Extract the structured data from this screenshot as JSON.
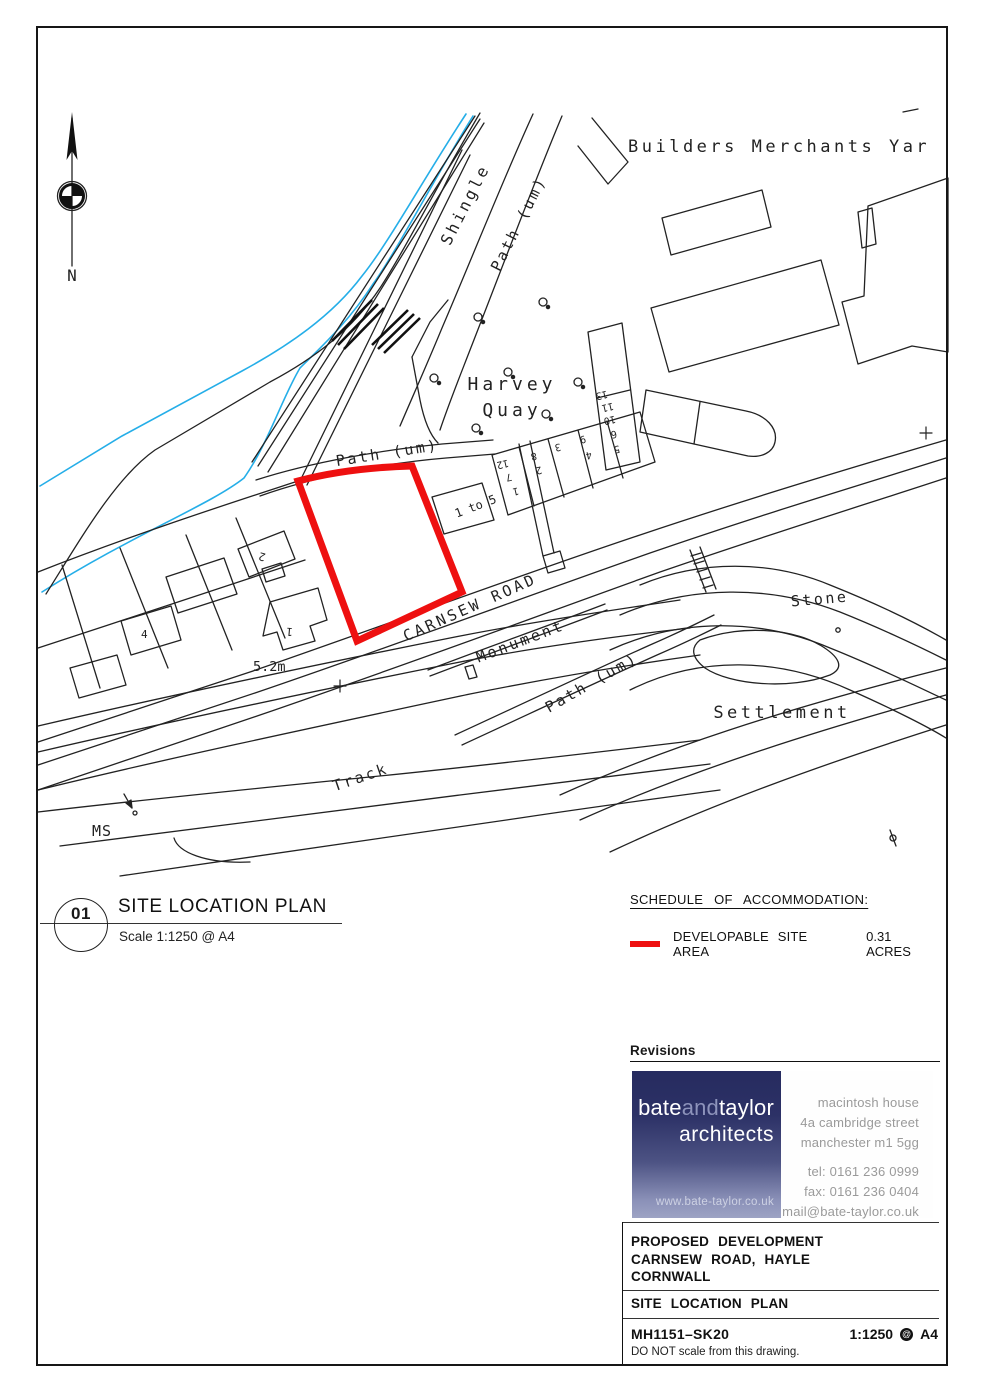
{
  "page": {
    "title_circle": "01",
    "drawing_title": "SITE LOCATION PLAN",
    "scale_note": "Scale 1:1250 @ A4"
  },
  "legend": {
    "heading": "SCHEDULE OF ACCOMMODATION:",
    "item_label": "DEVELOPABLE SITE AREA",
    "item_value": "0.31 ACRES",
    "swatch_color": "#ee1010"
  },
  "revisions": {
    "heading": "Revisions"
  },
  "logo": {
    "name_part1": "bate",
    "name_part2": "and",
    "name_part3": "taylor",
    "subtitle": "architects",
    "website": "www.bate-taylor.co.uk",
    "address_lines": [
      "macintosh house",
      "4a cambridge street",
      "manchester m1 5gg"
    ],
    "contact_lines": [
      "tel: 0161 236 0999",
      "fax: 0161 236 0404",
      "mail@bate-taylor.co.uk"
    ]
  },
  "title_block": {
    "project_lines": [
      "PROPOSED DEVELOPMENT",
      "CARNSEW ROAD, HAYLE",
      "CORNWALL"
    ],
    "drawing_name": "SITE LOCATION PLAN",
    "drawing_number": "MH1151–SK20",
    "scale": "1:1250",
    "at_symbol": "@",
    "paper": "A4",
    "note": "DO NOT scale from this drawing."
  },
  "map": {
    "colors": {
      "site_outline": "#ee1010",
      "water": "#25aee8"
    },
    "labels": {
      "north": "N",
      "builders_merchants": "Builders Merchants Yar",
      "shingle": "Shingle",
      "path_um_upper": "Path (um)",
      "path_um_mid": "Path (um)",
      "path_um_lower": "Path (um)",
      "harvey_line1": "Harvey",
      "harvey_line2": "Quay",
      "carnsew_road": "CARNSEW ROAD",
      "monument": "Monument",
      "stone": "Stone",
      "settlement": "Settlement",
      "track": "Track",
      "ms": "MS",
      "spot_height": "5.2m",
      "one_to_five": "1 to 5"
    },
    "plot_numbers": [
      "12",
      "7",
      "1",
      "8",
      "2",
      "3",
      "9",
      "4",
      "13",
      "11",
      "10",
      "6",
      "5"
    ],
    "house_numbers": [
      "2",
      "4",
      "1"
    ]
  }
}
